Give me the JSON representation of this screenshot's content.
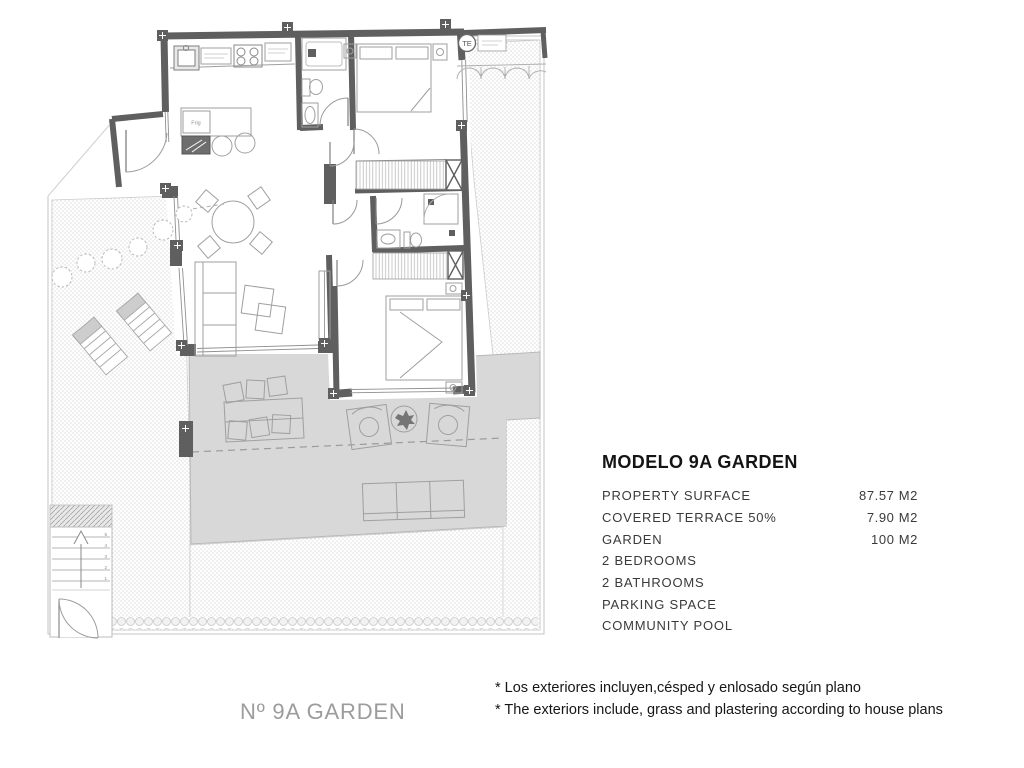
{
  "panel": {
    "title": "MODELO 9A GARDEN",
    "rows": [
      {
        "label": "PROPERTY SURFACE",
        "value": "87.57 M2"
      },
      {
        "label": "COVERED TERRACE 50%",
        "value": "7.90 M2"
      },
      {
        "label": "GARDEN",
        "value": "100 M2"
      },
      {
        "label": "2 BEDROOMS",
        "value": ""
      },
      {
        "label": "2 BATHROOMS",
        "value": ""
      },
      {
        "label": "PARKING SPACE",
        "value": ""
      },
      {
        "label": "COMMUNITY POOL",
        "value": ""
      }
    ]
  },
  "notes": {
    "line1": "* Los exteriores incluyen,césped y enlosado según plano",
    "line2": "* The exteriors include, grass and plastering according to house plans"
  },
  "plan": {
    "unit_label": "Nº 9A GARDEN",
    "te_label": "TE",
    "fridge_label": "Frig",
    "stair_numbers": [
      "5",
      "4",
      "3",
      "2",
      "1"
    ],
    "colors": {
      "wall": "#5f5f5f",
      "terrace_fill": "#d8d8d8",
      "furniture_line": "#9f9f9f",
      "boundary_line": "#c6c6c6",
      "garden_dot": "#d2d2d2"
    }
  }
}
